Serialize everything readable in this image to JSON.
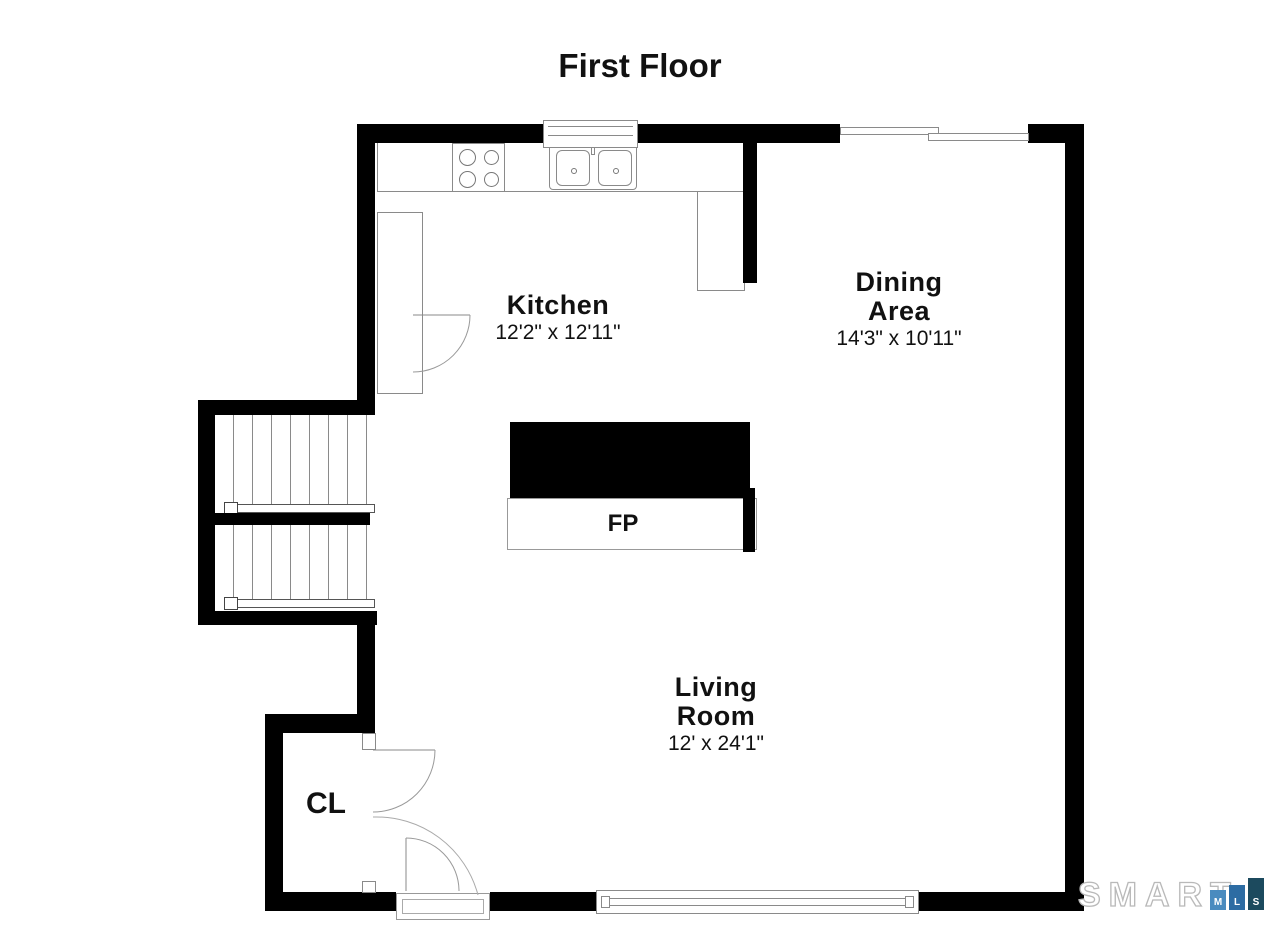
{
  "title": "First Floor",
  "rooms": {
    "kitchen": {
      "name": "Kitchen",
      "dims": "12'2\" x 12'11\""
    },
    "dining": {
      "line1": "Dining",
      "line2": "Area",
      "dims": "14'3\" x 10'11\""
    },
    "living": {
      "line1": "Living",
      "line2": "Room",
      "dims": "12' x 24'1\""
    }
  },
  "features": {
    "fireplace": "FP",
    "closet": "CL"
  },
  "logo": {
    "brand": "SMART",
    "squares": [
      {
        "letter": "M",
        "color": "#4a8bbf"
      },
      {
        "letter": "L",
        "color": "#2d6ca3"
      },
      {
        "letter": "S",
        "color": "#1c4a5e"
      }
    ]
  },
  "colors": {
    "wall": "#000000",
    "line": "#8a8a8a",
    "background": "#ffffff"
  }
}
